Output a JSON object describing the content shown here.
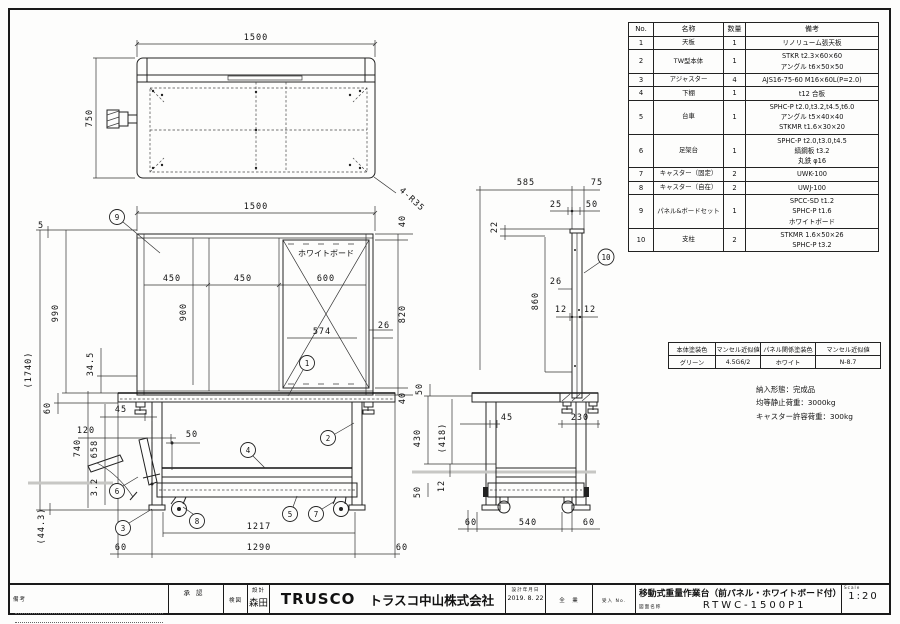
{
  "views": {
    "top": {
      "dims": {
        "width": "1500",
        "depth": "750",
        "corner": "4-R35"
      }
    },
    "front": {
      "whiteboard_label": "ホワイトボード",
      "dims": {
        "width": "1500",
        "five": "5",
        "p450a": "450",
        "p450b": "450",
        "p600": "600",
        "p900": "900",
        "p990": "990",
        "total": "(1740)",
        "board574": "574",
        "gap26": "26",
        "p820": "820",
        "f40t": "40",
        "f40b": "40",
        "t34_5": "34.5",
        "a60": "60",
        "h740": "740",
        "c658": "658",
        "t3_2": "3.2",
        "c44_3": "(44.3)",
        "i45": "45",
        "i120": "120",
        "i50": "50",
        "b1217": "1217",
        "b1290": "1290",
        "o60l": "60",
        "o60r": "60"
      }
    },
    "side": {
      "dims": {
        "d585": "585",
        "d75": "75",
        "d25": "25",
        "d50w": "50",
        "d22": "22",
        "d860": "860",
        "d26": "26",
        "d12a": "12",
        "d12b": "12",
        "g50": "50",
        "c430": "430",
        "c418": "(418)",
        "s12": "12",
        "b50": "50",
        "i45": "45",
        "s230": "230",
        "o60l": "60",
        "w540": "540",
        "o60r": "60"
      }
    },
    "balloons": {
      "b1": "1",
      "b2": "2",
      "b3": "3",
      "b4": "4",
      "b5": "5",
      "b6": "6",
      "b7": "7",
      "b8": "8",
      "b9": "9",
      "b10": "10"
    }
  },
  "parts_table": {
    "headers": {
      "no": "No.",
      "name": "名称",
      "qty": "数量",
      "remark": "備考"
    },
    "rows": [
      {
        "no": "1",
        "name": "天板",
        "qty": "1",
        "remark": "リノリューム張天板"
      },
      {
        "no": "2",
        "name": "TW型本体",
        "qty": "1",
        "remark": "STKR  t2.3×60×60\nアングル t6×50×50"
      },
      {
        "no": "3",
        "name": "アジャスター",
        "qty": "4",
        "remark": "AJS16-75-60 M16×60L(P=2.0)"
      },
      {
        "no": "4",
        "name": "下棚",
        "qty": "1",
        "remark": "t12 合板"
      },
      {
        "no": "5",
        "name": "台車",
        "qty": "1",
        "remark": "SPHC-P t2.0,t3.2,t4.5,t6.0\nアングル t5×40×40\nSTKMR t1.6×30×20"
      },
      {
        "no": "6",
        "name": "足架台",
        "qty": "1",
        "remark": "SPHC-P t2.0,t3.0,t4.5\n縞鋼板 t3.2\n丸鉄 φ16"
      },
      {
        "no": "7",
        "name": "キャスター（固定）",
        "qty": "2",
        "remark": "UWK-100"
      },
      {
        "no": "8",
        "name": "キャスター（自在）",
        "qty": "2",
        "remark": "UWJ-100"
      },
      {
        "no": "9",
        "name": "パネル&ボードセット",
        "qty": "1",
        "remark": "SPCC-SD t1.2\nSPHC-P t1.6\nホワイトボード"
      },
      {
        "no": "10",
        "name": "支柱",
        "qty": "2",
        "remark": "STKMR 1.6×50×26\nSPHC-P t3.2"
      }
    ]
  },
  "color_table": {
    "headers": [
      "本体塗装色",
      "マンセル近似値",
      "パネル関係塗装色",
      "マンセル近似値"
    ],
    "values": [
      "グリーン",
      "4.5G6/2",
      "ホワイト",
      "N-8.7"
    ]
  },
  "notes": {
    "line1": "納入形態：完成品",
    "line2": "均等静止荷重：3000kg",
    "line3": "キャスター許容荷重：300kg"
  },
  "title_block": {
    "remarks_label": "備考",
    "approval_label": "承認",
    "check_label": "検図",
    "design_label": "設計",
    "designer": "森田",
    "logo": "TRUSCO",
    "company": "トラスコ中山株式会社",
    "date_label": "設計年月日",
    "date": "2019. 8. 22",
    "dept_label": "全　業",
    "receipt_label": "受入 No.",
    "title": "移動式重量作業台（前パネル・ホワイトボード付）",
    "number_label": "図面名称",
    "number": "RTWC-1500P1",
    "scale_label": "Scale",
    "scale": "1:20"
  }
}
